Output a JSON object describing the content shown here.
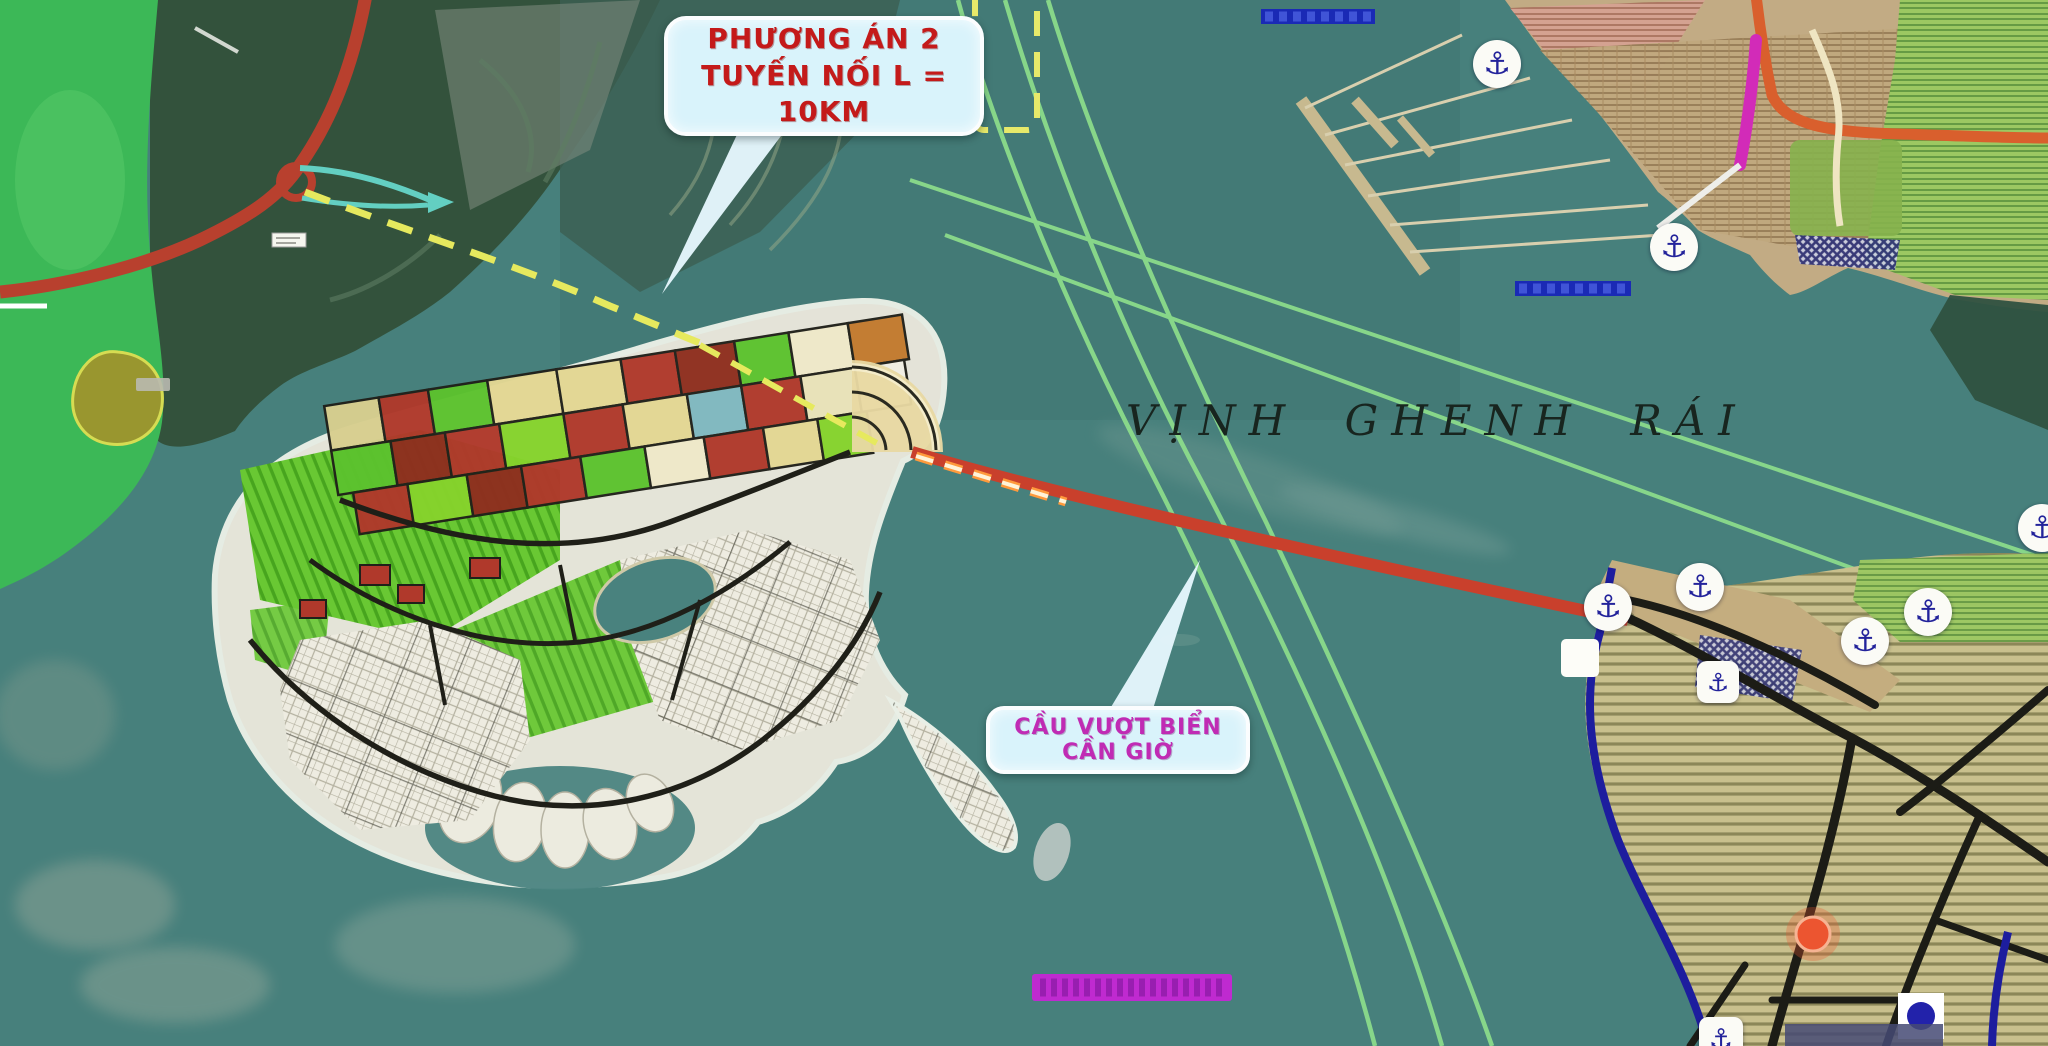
{
  "map": {
    "bay_label": "VỊNH GHENH RÁI",
    "callout_option": {
      "line1": "PHƯƠNG ÁN 2",
      "line2": "TUYẾN NỐI L = 10KM"
    },
    "callout_bridge": {
      "label": "CẦU VƯỢT BIỂN CẦN GIỜ"
    },
    "anchor_icon": "⚓",
    "colors": {
      "water": "#47807c",
      "route_red": "#c9402c",
      "inland_road_red": "#b8402e",
      "channel_green": "#8fe08c",
      "dashed_yellow": "#e6e95e",
      "callout_bg": "#d9f3fb",
      "option_text": "#c41a1a",
      "bridge_text": "#c02bb4",
      "coastline_navy": "#1d1d9e",
      "magenta_bar": "#bf2ad0",
      "blue_bar": "#1a2ab5",
      "mangrove_green": "#33523c",
      "park_green": "#3cb857",
      "urban_block_red": "#b0392b",
      "urban_block_yellow": "#e3d793",
      "land_tan": "#c9c08d"
    }
  }
}
